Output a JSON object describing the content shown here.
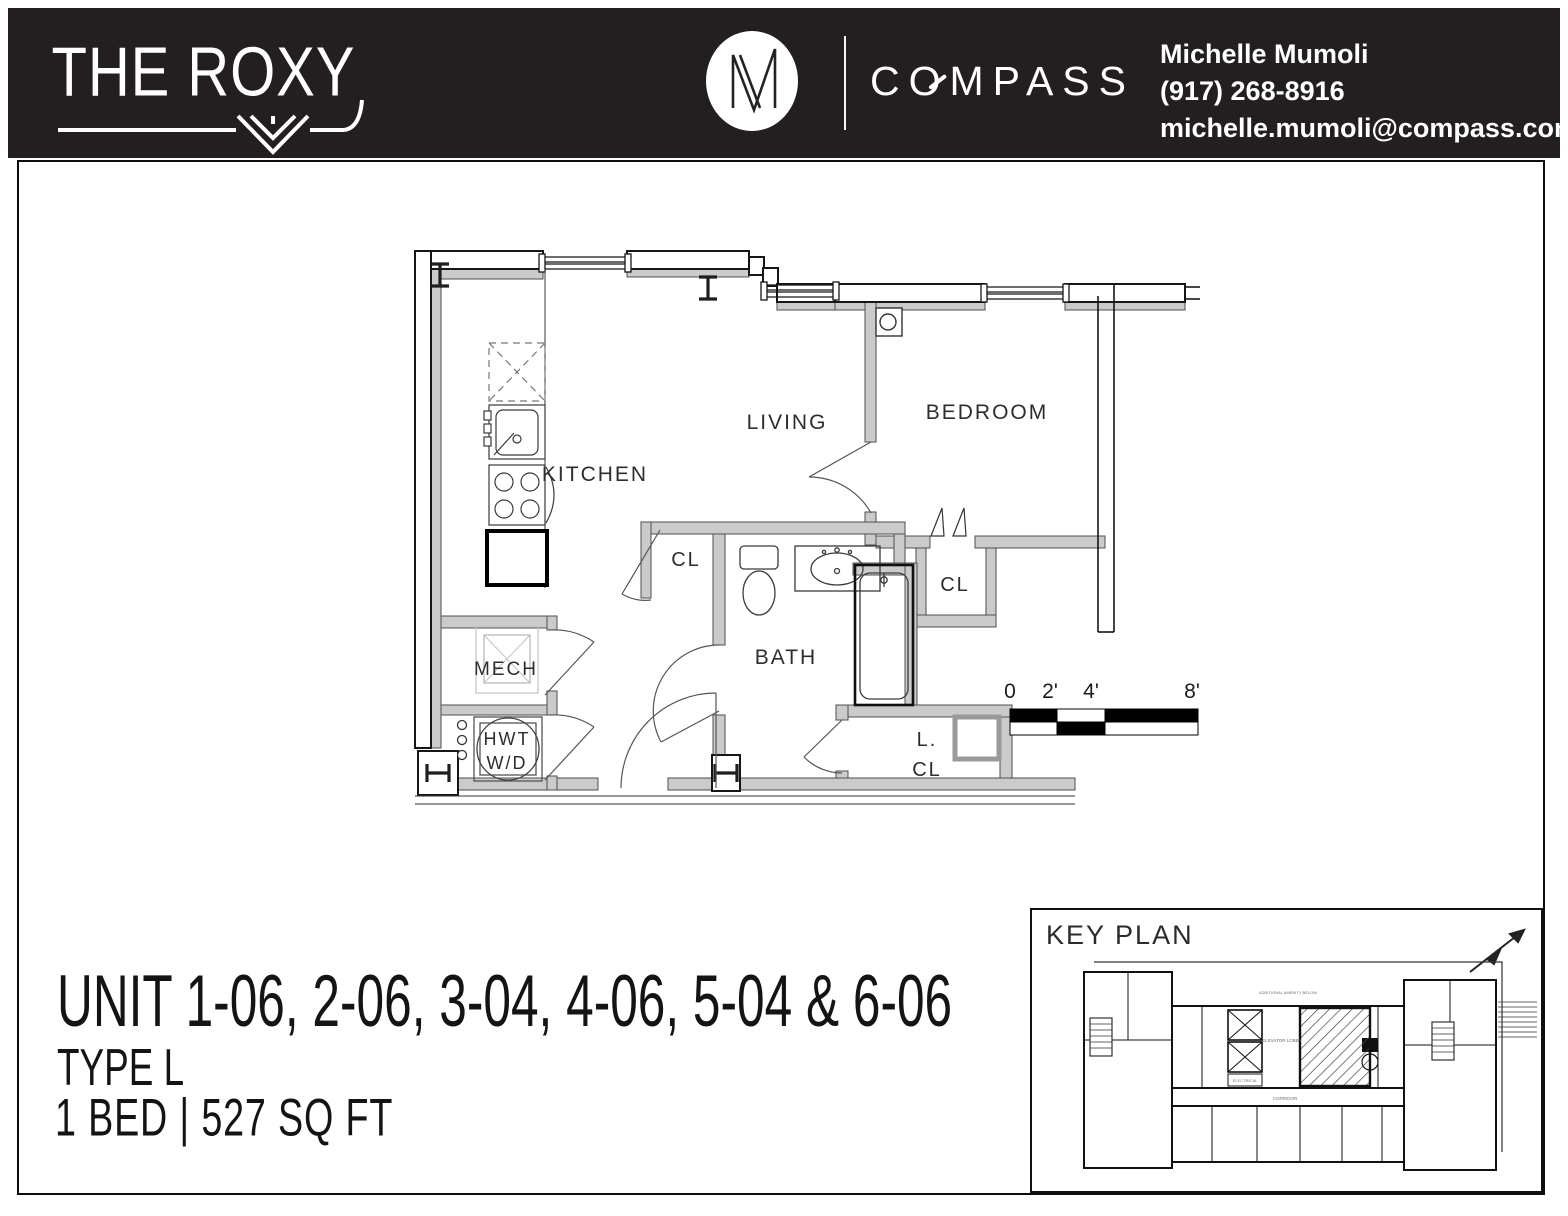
{
  "header": {
    "building_name": "THE ROXY",
    "monogram": "M",
    "brand": "COMPASS",
    "agent": {
      "name": "Michelle Mumoli",
      "phone": "(917) 268-8916",
      "email": "michelle.mumoli@compass.com"
    }
  },
  "plan": {
    "rooms": {
      "kitchen": "KITCHEN",
      "living": "LIVING",
      "bedroom": "BEDROOM",
      "bath": "BATH",
      "mech": "MECH",
      "hwt": "HWT",
      "wd": "W/D",
      "closet_hall": "CL",
      "closet_bedroom": "CL",
      "linen_line1": "L.",
      "linen_line2": "CL"
    },
    "scale_bar": {
      "zero": "0",
      "two": "2'",
      "four": "4'",
      "eight": "8'"
    }
  },
  "footer": {
    "unit_title": "UNIT 1-06, 2-06, 3-04, 4-06, 5-04 & 6-06",
    "type_label": "TYPE L",
    "bed_sqft": "1 BED | 527 SQ FT"
  },
  "key_plan": {
    "title": "KEY PLAN",
    "labels": {
      "amenity_note": "ADDITIONAL AMENITY BELOW",
      "elevator_lobby": "ELEVATOR LOBBY",
      "electrical": "ELECTRICAL",
      "corridor": "CORRIDOR"
    }
  },
  "colors": {
    "header_bg": "#231f20",
    "wall_gray": "#cbcbcb",
    "line_dark": "#222222"
  }
}
